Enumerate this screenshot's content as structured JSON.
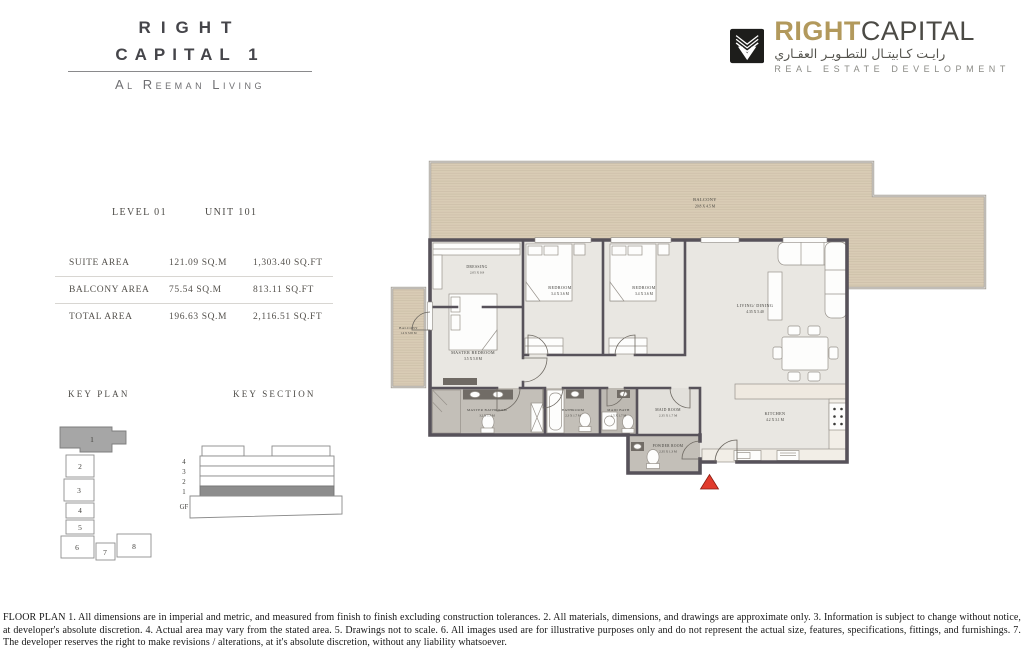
{
  "header": {
    "line1": "RIGHT",
    "line2": "CAPITAL 1",
    "subtitle": "Al Reeman Living"
  },
  "logo": {
    "word1": "RIGHT",
    "word2": "CAPITAL",
    "arabic": "رايـت كـابيتـال للتطـويـر العقـاري",
    "tagline": "REAL ESTATE DEVELOPMENT",
    "gold_color": "#b2995c",
    "dark_color": "#4b4a45"
  },
  "unit_info": {
    "level": "LEVEL 01",
    "unit": "UNIT 101",
    "areas": [
      {
        "label": "SUITE AREA",
        "sqm": "121.09 SQ.M",
        "sqft": "1,303.40 SQ.FT"
      },
      {
        "label": "BALCONY AREA",
        "sqm": "75.54 SQ.M",
        "sqft": "813.11 SQ.FT"
      },
      {
        "label": "TOTAL AREA",
        "sqm": "196.63 SQ.M",
        "sqft": "2,116.51 SQ.FT"
      }
    ]
  },
  "key_plan": {
    "title": "KEY PLAN",
    "highlighted_unit": "1",
    "units": [
      "1",
      "2",
      "3",
      "4",
      "5",
      "6",
      "7",
      "8"
    ]
  },
  "key_section": {
    "title": "KEY SECTION",
    "highlighted_floor": "1",
    "floors": [
      "4",
      "3",
      "2",
      "1",
      "GF"
    ]
  },
  "floor_plan": {
    "entrance_marker_color": "#e13b2c",
    "rooms": {
      "balcony_top": {
        "name": "BALCONY",
        "dims": "20.8 X 4.5 M"
      },
      "balcony_left": {
        "name": "BALCONY",
        "dims": "1.4 X 3.65 M"
      },
      "dressing": {
        "name": "DRESSING",
        "dims": "2.05 X 0.9"
      },
      "master_bedroom": {
        "name": "MASTER BEDROOM",
        "dims": "3.5 X 5.8 M"
      },
      "bedroom_1": {
        "name": "BEDROOM",
        "dims": "3.4 X 3.6 M"
      },
      "bedroom_2": {
        "name": "BEDROOM",
        "dims": "3.4 X 3.6 M"
      },
      "living_dining": {
        "name": "LIVING/ DINING",
        "dims": "4.35 X 5.40"
      },
      "master_bathroom": {
        "name": "MASTER BATHROOM",
        "dims": "3.2 X 1.7 M"
      },
      "bathroom": {
        "name": "BATHROOM",
        "dims": "2.3 X 1.7 M"
      },
      "maid_bath": {
        "name": "MAID BATH",
        "dims": "1.5 X 1.7 M"
      },
      "maid_room": {
        "name": "MAID ROOM",
        "dims": "2.35 X 1.7 M"
      },
      "powder_room": {
        "name": "POWDER ROOM",
        "dims": "2.35 X 1.3 M"
      },
      "kitchen": {
        "name": "KITCHEN",
        "dims": "4.2 X 3.1 M"
      }
    }
  },
  "disclaimer": {
    "text": "FLOOR PLAN 1. All dimensions are in imperial and metric, and measured from finish to finish excluding construction tolerances. 2. All materials, dimensions, and drawings are approximate only. 3. Information is subject to change without notice, at developer's absolute discretion. 4. Actual area may vary from the stated area. 5. Drawings not to scale. 6. All images used are for illustrative purposes only and do not represent the actual size, features, specifications, fittings, and furnishings. 7. The developer reserves the right to make revisions / alterations, at it's absolute discretion, without any liability whatsoever."
  }
}
